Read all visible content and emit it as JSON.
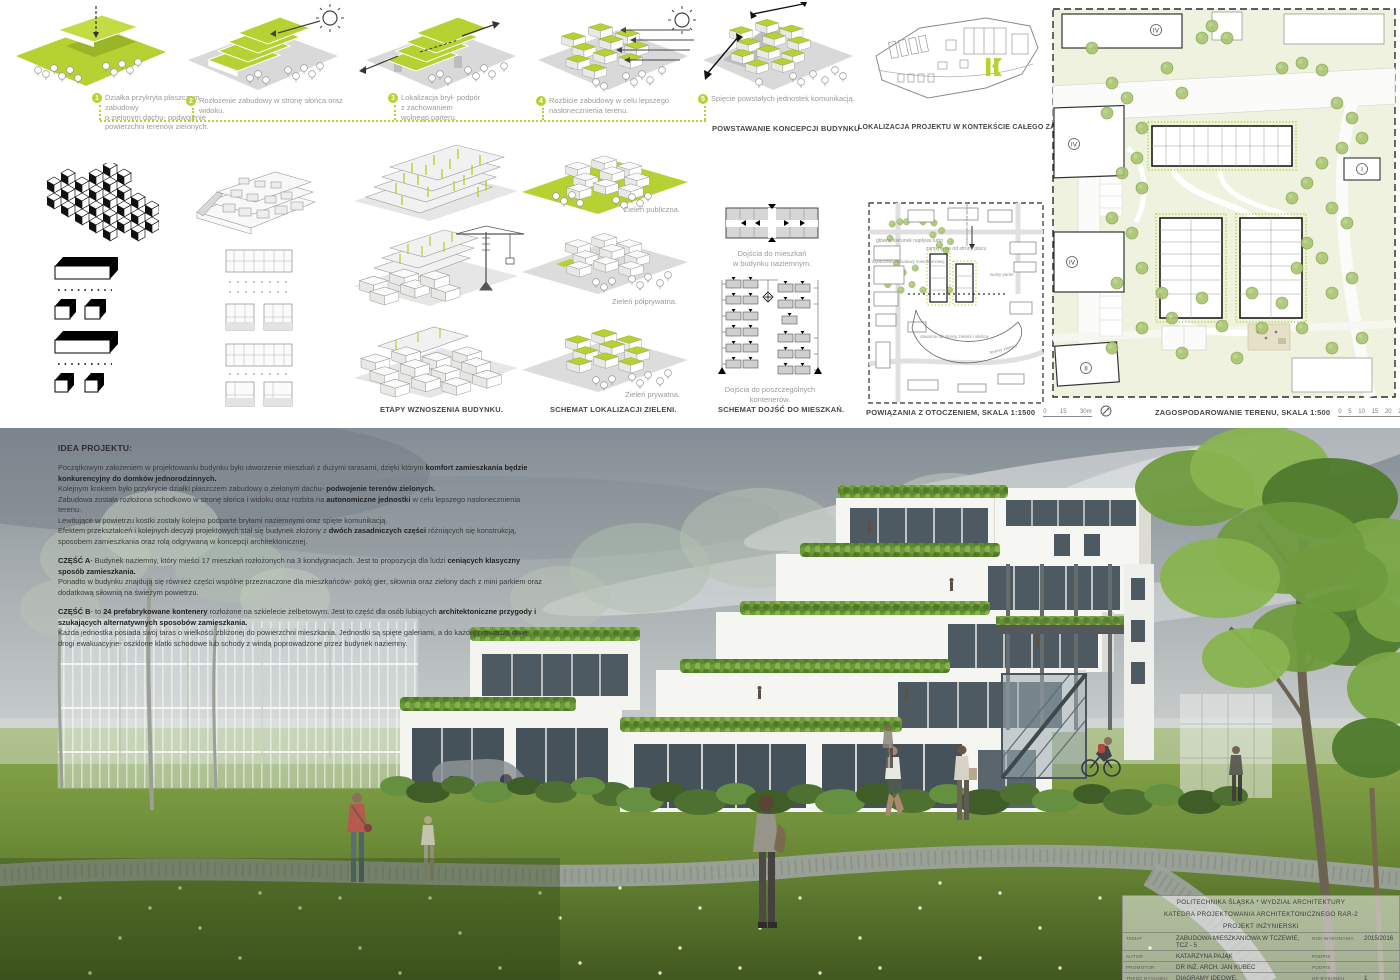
{
  "colors": {
    "accent": "#b5d232",
    "caption_grey": "#9b9b9b",
    "label_dark": "#474747",
    "sky": "#8d969d",
    "grass": "#6f8f3a"
  },
  "concept": {
    "flow_label": "POWSTAWANIE KONCEPCJI BUDYNKU",
    "steps": [
      {
        "num": "1",
        "caption": "Działka przykryta płaszczem zabudowy\no zielonym dachu- podwojenie\npowierzchni terenów zielonych."
      },
      {
        "num": "2",
        "caption": "Rozłożenie zabudowy w stronę słońca oraz widoku."
      },
      {
        "num": "3",
        "caption": "Lokalizacja brył- podpór\nz zachowaniem\nwolnego parteru."
      },
      {
        "num": "4",
        "caption": "Rozbicie zabudowy w celu lepszego\nnasłonecznienia terenu."
      },
      {
        "num": "5",
        "caption": "Spięcie powstałych jednostek komunikacją."
      }
    ]
  },
  "context_map": {
    "label": "LOKALIZACJA PROJEKTU W KONTEKŚCIE CAŁEGO ZAŁOŻENIA"
  },
  "stages": {
    "label": "ETAPY WZNOSZENIA BUDYNKU."
  },
  "greenery": {
    "label": "SCHEMAT LOKALIZACJI ZIELENI.",
    "items": [
      "Zieleń publiczna.",
      "Zieleń półprywatna.",
      "Zieleń prywatna."
    ]
  },
  "access": {
    "label": "SCHEMAT DOJŚĆ DO MIESZKAŃ.",
    "captions": [
      "Dojścia do mieszkań\nw budynku naziemnym.",
      "Dojścia do poszczególnych\nkontenerów."
    ]
  },
  "surroundings": {
    "label": "POWIĄZANIA Z OTOCZENIEM, SKALA 1:1500",
    "scale_ticks": "0        15        30m",
    "annotations": [
      "główny kierunek napływu ludzi",
      "zamknięcie od strony placu",
      "sąsiedztwo zabudowy mieszkaniowej",
      "wolny parter",
      "otwarcie od strony zieleni i słońca",
      "tereny zielone",
      "lokalizacja na osi widokowej placu"
    ]
  },
  "siteplan": {
    "label": "ZAGOSPODAROWANIE TERENU, SKALA 1:500",
    "scale_ticks": "0    5    10    15    20    25m",
    "markers": [
      "IV",
      "IV",
      "IV",
      "I",
      "II"
    ],
    "parking_label": "P4"
  },
  "idea": {
    "title": "IDEA PROJEKTU:",
    "paragraphs": [
      {
        "runs": [
          {
            "t": "Początkowym założeniem w projektowaniu budynku było utworzenie mieszkań z dużymi tarasami, dzięki którym "
          },
          {
            "t": "komfort zamieszkania będzie konkurencyjny do domków jednorodzinnych.",
            "b": true
          }
        ]
      },
      {
        "runs": [
          {
            "t": "Kolejnym krokiem było przykrycie działki płaszczem zabudowy o zielonym dachu- "
          },
          {
            "t": "podwojenie terenów zielonych.",
            "b": true
          }
        ]
      },
      {
        "runs": [
          {
            "t": "Zabudowa została rozłożona schodkowo w stronę słońca i widoku oraz rozbita na "
          },
          {
            "t": "autonomiczne jednostki",
            "b": true
          },
          {
            "t": " w celu lepszego nasłonecznienia terenu."
          }
        ]
      },
      {
        "runs": [
          {
            "t": "Lewitujące w powietrzu kostki zostały kolejno podparte bryłami naziemnymi oraz spięte komunikacją."
          }
        ]
      },
      {
        "runs": [
          {
            "t": "Efektem przekształceń i kolejnych decyzji projektowych stał się budynek złożony z "
          },
          {
            "t": "dwóch zasadniczych części",
            "b": true
          },
          {
            "t": " różniących się konstrukcją, sposobem zamieszkania oraz rolą odgrywaną w koncepcji architektonicznej."
          }
        ]
      },
      {
        "gap": true,
        "runs": [
          {
            "t": "CZĘŚĆ A",
            "b": true
          },
          {
            "t": "- Budynek naziemny, który mieści 17 mieszkań rozłożonych na 3 kondygnacjach. Jest to propozycja dla ludzi "
          },
          {
            "t": "ceniących klasyczny sposób zamieszkania.",
            "b": true
          }
        ]
      },
      {
        "runs": [
          {
            "t": "Ponadto w budynku znajdują się również części wspólne przeznaczone dla mieszkańców- pokój gier, siłownia oraz zielony dach z mini parkiem oraz dodatkową siłownią na świeżym powietrzu."
          }
        ]
      },
      {
        "gap": true,
        "runs": [
          {
            "t": "CZĘŚĆ B",
            "b": true
          },
          {
            "t": "- to "
          },
          {
            "t": "24 prefabrykowane kontenery",
            "b": true
          },
          {
            "t": " rozłożone na szkielecie żelbetowym. Jest to część dla osób lubiących "
          },
          {
            "t": "architektoniczne przygody i szukających alternatywnych sposobów zamieszkania.",
            "b": true
          }
        ]
      },
      {
        "runs": [
          {
            "t": "Każda jednostka posiada swój taras o wielkości zbliżonej do powierzchni mieszkania. Jednostki są spięte galeriami, a do każdej prowadzą dwie drogi ewakuacyjne- oszklone klatki schodowe lub schody z windą poprowadzone przez budynek naziemny."
          }
        ]
      }
    ]
  },
  "titleblock": {
    "line1": "POLITECHNIKA ŚLĄSKA * WYDZIAŁ ARCHITEKTURY",
    "line2": "KATEDRA PROJEKTOWANIA ARCHITEKTONICZNEGO RAR-2",
    "line3": "PROJEKT INŻYNIERSKI",
    "rows": [
      {
        "label": "TEMAT",
        "value": "ZABUDOWA MIESZKANIOWA W TCZEWIE, TCZ - 5",
        "label2": "ROK WYKONANIA",
        "value2": "2015/2016"
      },
      {
        "label": "AUTOR",
        "value": "KATARZYNA PAJĄK",
        "label2": "PODPIS",
        "value2": ""
      },
      {
        "label": "PROMOTOR",
        "value": "DR INŻ. ARCH. JAN KUBEC",
        "label2": "PODPIS",
        "value2": ""
      },
      {
        "label": "TREŚĆ RYSUNKU",
        "value": "DIAGRAMY IDEOWE, ZAGOSPODAROWANIE TERENU",
        "label2": "NR RYSUNKU",
        "value2": "1"
      }
    ]
  }
}
